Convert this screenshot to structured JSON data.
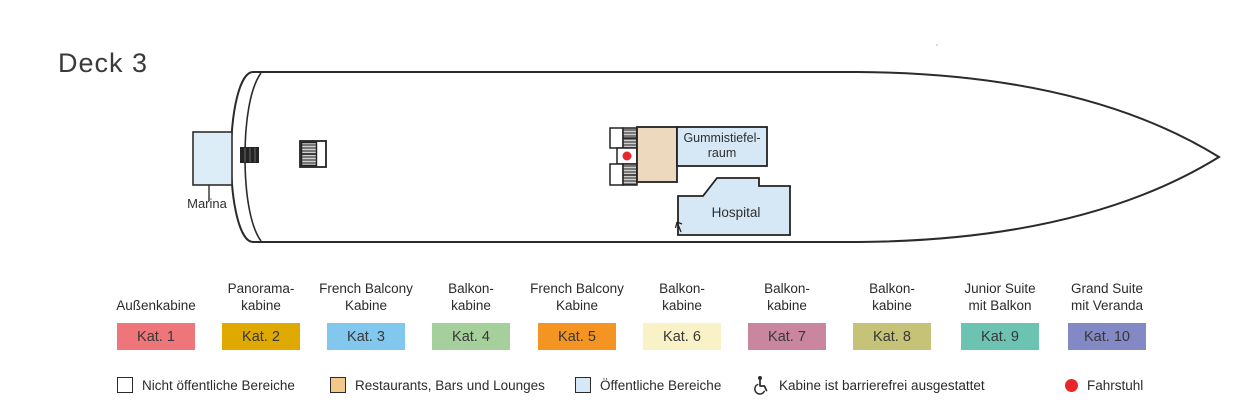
{
  "title": "Deck 3",
  "ship": {
    "rooms": {
      "marina": "Marina",
      "gummistiefelraum_line1": "Gummistiefel-",
      "gummistiefelraum_line2": "raum",
      "hospital": "Hospital"
    }
  },
  "colors": {
    "outline": "#2b2b2b",
    "public_room": "#d6e8f6",
    "marina_room": "#dcedf8",
    "restaurant_room": "#edd9bd",
    "elevator": "#e8262c",
    "hatch_dark": "#3f3f3f"
  },
  "categories": [
    {
      "lines": [
        "Außenkabine"
      ],
      "label": "Kat. 1",
      "color": "#ee767a"
    },
    {
      "lines": [
        "Panorama-",
        "kabine"
      ],
      "label": "Kat. 2",
      "color": "#dfa900"
    },
    {
      "lines": [
        "French Balcony",
        "Kabine"
      ],
      "label": "Kat. 3",
      "color": "#82c8ee"
    },
    {
      "lines": [
        "Balkon-",
        "kabine"
      ],
      "label": "Kat. 4",
      "color": "#a5cf9b"
    },
    {
      "lines": [
        "French Balcony",
        "Kabine"
      ],
      "label": "Kat. 5",
      "color": "#f49423"
    },
    {
      "lines": [
        "Balkon-",
        "kabine"
      ],
      "label": "Kat. 6",
      "color": "#f8f2c6"
    },
    {
      "lines": [
        "Balkon-",
        "kabine"
      ],
      "label": "Kat. 7",
      "color": "#c9869e"
    },
    {
      "lines": [
        "Balkon-",
        "kabine"
      ],
      "label": "Kat. 8",
      "color": "#c6c378"
    },
    {
      "lines": [
        "Junior Suite",
        "mit Balkon"
      ],
      "label": "Kat. 9",
      "color": "#6cc3b1"
    },
    {
      "lines": [
        "Grand Suite",
        "mit Veranda"
      ],
      "label": "Kat. 10",
      "color": "#8289c5"
    }
  ],
  "legend": [
    {
      "label": "Nicht öffentliche Bereiche",
      "swatch": "#ffffff"
    },
    {
      "label": "Restaurants, Bars und Lounges",
      "swatch": "#f2c98b"
    },
    {
      "label": "Öffentliche Bereiche",
      "swatch": "#d6e8f6"
    },
    {
      "label": "Kabine ist barrierefrei ausgestattet"
    },
    {
      "label": "Fahrstuhl",
      "color": "#e8262c"
    }
  ]
}
